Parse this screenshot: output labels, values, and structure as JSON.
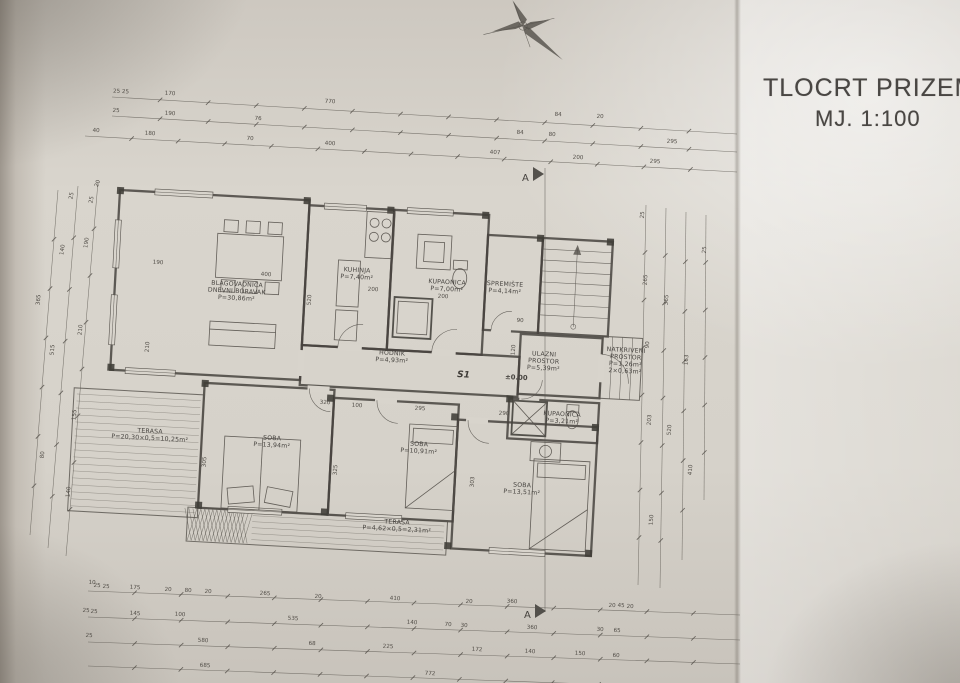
{
  "title": {
    "line1": "TLOCRT PRIZEMLJA",
    "line2": "MJ. 1:100"
  },
  "plan": {
    "ink_color": "#47433e",
    "paper_color": "#d8d4cc",
    "marks": {
      "section": "A",
      "stair": "S1",
      "level": "±0.00"
    },
    "room_labels": [
      {
        "id": "blagovaonica-dnevni-boravak",
        "x": 237,
        "y": 286,
        "r": 3,
        "lines": [
          "BLAGOVAONICA",
          "DNEVNI BORAVAK",
          "P=30,86m²"
        ]
      },
      {
        "id": "kuhinja",
        "x": 357,
        "y": 272,
        "r": 3,
        "lines": [
          "KUHINJA",
          "P=7,40m²"
        ]
      },
      {
        "id": "kupaonica-1",
        "x": 447,
        "y": 284,
        "r": 3,
        "lines": [
          "KUPAONICA",
          "P=7,00m²"
        ]
      },
      {
        "id": "spremiste",
        "x": 505,
        "y": 286,
        "r": 3,
        "lines": [
          "SPREMIŠTE",
          "P=4,14m²"
        ]
      },
      {
        "id": "hodnik",
        "x": 392,
        "y": 355,
        "r": 3,
        "lines": [
          "HODNIK",
          "P=4,93m²"
        ]
      },
      {
        "id": "ulazni-prostor",
        "x": 544,
        "y": 356,
        "r": 3,
        "lines": [
          "ULAZNI",
          "PROSTOR",
          "P=5,39m²"
        ]
      },
      {
        "id": "natkriveni-prostor",
        "x": 626,
        "y": 352,
        "r": 3,
        "lines": [
          "NATKRIVENI",
          "PROSTOR",
          "P=1,26m²",
          "2×0,63m²"
        ]
      },
      {
        "id": "soba-1",
        "x": 272,
        "y": 440,
        "r": 3,
        "lines": [
          "SOBA",
          "P=13,94m²"
        ]
      },
      {
        "id": "soba-2",
        "x": 419,
        "y": 446,
        "r": 3,
        "lines": [
          "SOBA",
          "P=10,91m²"
        ]
      },
      {
        "id": "soba-3",
        "x": 522,
        "y": 487,
        "r": 3,
        "lines": [
          "SOBA",
          "P=13,51m²"
        ]
      },
      {
        "id": "kupaonica-2",
        "x": 562,
        "y": 416,
        "r": 3,
        "lines": [
          "KUPAONICA",
          "P=3,21m²"
        ]
      },
      {
        "id": "terasa-1",
        "x": 150,
        "y": 433,
        "r": 3,
        "lines": [
          "TERASA",
          "P=20,30×0,5=10,25m²"
        ]
      },
      {
        "id": "terasa-2",
        "x": 397,
        "y": 524,
        "r": 3,
        "lines": [
          "TERASA",
          "P=4,62×0,5=2,31m²"
        ]
      }
    ],
    "dims": [
      {
        "t": "25 25",
        "x": 121,
        "y": 93
      },
      {
        "t": "170",
        "x": 170,
        "y": 95
      },
      {
        "t": "770",
        "x": 330,
        "y": 103
      },
      {
        "t": "84",
        "x": 558,
        "y": 116
      },
      {
        "t": "20",
        "x": 600,
        "y": 118
      },
      {
        "t": "25",
        "x": 116,
        "y": 112
      },
      {
        "t": "190",
        "x": 170,
        "y": 115
      },
      {
        "t": "76",
        "x": 258,
        "y": 120
      },
      {
        "t": "84",
        "x": 520,
        "y": 134
      },
      {
        "t": "80",
        "x": 552,
        "y": 136
      },
      {
        "t": "295",
        "x": 672,
        "y": 143
      },
      {
        "t": "40",
        "x": 96,
        "y": 132
      },
      {
        "t": "180",
        "x": 150,
        "y": 135
      },
      {
        "t": "70",
        "x": 250,
        "y": 140
      },
      {
        "t": "400",
        "x": 330,
        "y": 145
      },
      {
        "t": "407",
        "x": 495,
        "y": 154
      },
      {
        "t": "200",
        "x": 578,
        "y": 159
      },
      {
        "t": "295",
        "x": 655,
        "y": 163
      },
      {
        "t": "400",
        "x": 266,
        "y": 276
      },
      {
        "t": "190",
        "x": 158,
        "y": 264
      },
      {
        "t": "200",
        "x": 373,
        "y": 291
      },
      {
        "t": "200",
        "x": 443,
        "y": 298
      },
      {
        "t": "320",
        "x": 325,
        "y": 404
      },
      {
        "t": "100",
        "x": 357,
        "y": 407
      },
      {
        "t": "295",
        "x": 420,
        "y": 410
      },
      {
        "t": "290",
        "x": 504,
        "y": 415
      },
      {
        "t": "90",
        "x": 520,
        "y": 322
      },
      {
        "t": "520",
        "x": 311,
        "y": 300,
        "r": -86
      },
      {
        "t": "210",
        "x": 149,
        "y": 347,
        "r": -86
      },
      {
        "t": "305",
        "x": 206,
        "y": 462,
        "r": -86
      },
      {
        "t": "325",
        "x": 337,
        "y": 470,
        "r": -86
      },
      {
        "t": "303",
        "x": 474,
        "y": 482,
        "r": -86
      },
      {
        "t": "120",
        "x": 515,
        "y": 350,
        "r": -86
      },
      {
        "t": "10",
        "x": 92,
        "y": 584
      },
      {
        "t": "25",
        "x": 97,
        "y": 587
      },
      {
        "t": "25",
        "x": 106,
        "y": 588
      },
      {
        "t": "175",
        "x": 135,
        "y": 589
      },
      {
        "t": "20",
        "x": 168,
        "y": 591
      },
      {
        "t": "80",
        "x": 188,
        "y": 592
      },
      {
        "t": "20",
        "x": 208,
        "y": 593
      },
      {
        "t": "265",
        "x": 265,
        "y": 595
      },
      {
        "t": "20",
        "x": 318,
        "y": 598
      },
      {
        "t": "410",
        "x": 395,
        "y": 600
      },
      {
        "t": "20",
        "x": 469,
        "y": 603
      },
      {
        "t": "360",
        "x": 512,
        "y": 603
      },
      {
        "t": "20",
        "x": 612,
        "y": 607
      },
      {
        "t": "45",
        "x": 621,
        "y": 607
      },
      {
        "t": "20",
        "x": 630,
        "y": 608
      },
      {
        "t": "25",
        "x": 86,
        "y": 612
      },
      {
        "t": "25",
        "x": 94,
        "y": 613
      },
      {
        "t": "145",
        "x": 135,
        "y": 615
      },
      {
        "t": "100",
        "x": 180,
        "y": 616
      },
      {
        "t": "535",
        "x": 293,
        "y": 620
      },
      {
        "t": "140",
        "x": 412,
        "y": 624
      },
      {
        "t": "70",
        "x": 448,
        "y": 626
      },
      {
        "t": "30",
        "x": 464,
        "y": 627
      },
      {
        "t": "360",
        "x": 532,
        "y": 629
      },
      {
        "t": "30",
        "x": 600,
        "y": 631
      },
      {
        "t": "65",
        "x": 617,
        "y": 632
      },
      {
        "t": "25",
        "x": 89,
        "y": 637
      },
      {
        "t": "580",
        "x": 203,
        "y": 642
      },
      {
        "t": "68",
        "x": 312,
        "y": 645
      },
      {
        "t": "225",
        "x": 388,
        "y": 648
      },
      {
        "t": "172",
        "x": 477,
        "y": 651
      },
      {
        "t": "140",
        "x": 530,
        "y": 653
      },
      {
        "t": "150",
        "x": 580,
        "y": 655
      },
      {
        "t": "60",
        "x": 616,
        "y": 657
      },
      {
        "t": "685",
        "x": 205,
        "y": 667
      },
      {
        "t": "772",
        "x": 430,
        "y": 675
      },
      {
        "t": "20",
        "x": 99,
        "y": 184,
        "r": -70
      },
      {
        "t": "25",
        "x": 93,
        "y": 200,
        "r": -80
      },
      {
        "t": "190",
        "x": 88,
        "y": 243,
        "r": -82
      },
      {
        "t": "210",
        "x": 82,
        "y": 330,
        "r": -84
      },
      {
        "t": "155",
        "x": 76,
        "y": 415,
        "r": -84
      },
      {
        "t": "140",
        "x": 70,
        "y": 492,
        "r": -84
      },
      {
        "t": "25",
        "x": 73,
        "y": 196,
        "r": -80
      },
      {
        "t": "140",
        "x": 64,
        "y": 250,
        "r": -82
      },
      {
        "t": "515",
        "x": 54,
        "y": 350,
        "r": -84
      },
      {
        "t": "80",
        "x": 44,
        "y": 455,
        "r": -84
      },
      {
        "t": "365",
        "x": 40,
        "y": 300,
        "r": -84
      },
      {
        "t": "25",
        "x": 644,
        "y": 215,
        "r": -86
      },
      {
        "t": "265",
        "x": 647,
        "y": 280,
        "r": -86
      },
      {
        "t": "90",
        "x": 649,
        "y": 345,
        "r": -86
      },
      {
        "t": "203",
        "x": 651,
        "y": 420,
        "r": -86
      },
      {
        "t": "150",
        "x": 653,
        "y": 520,
        "r": -86
      },
      {
        "t": "365",
        "x": 668,
        "y": 300,
        "r": -86
      },
      {
        "t": "520",
        "x": 671,
        "y": 430,
        "r": -86
      },
      {
        "t": "163",
        "x": 688,
        "y": 360,
        "r": -86
      },
      {
        "t": "410",
        "x": 692,
        "y": 470,
        "r": -86
      },
      {
        "t": "25",
        "x": 706,
        "y": 250,
        "r": -86
      }
    ]
  }
}
